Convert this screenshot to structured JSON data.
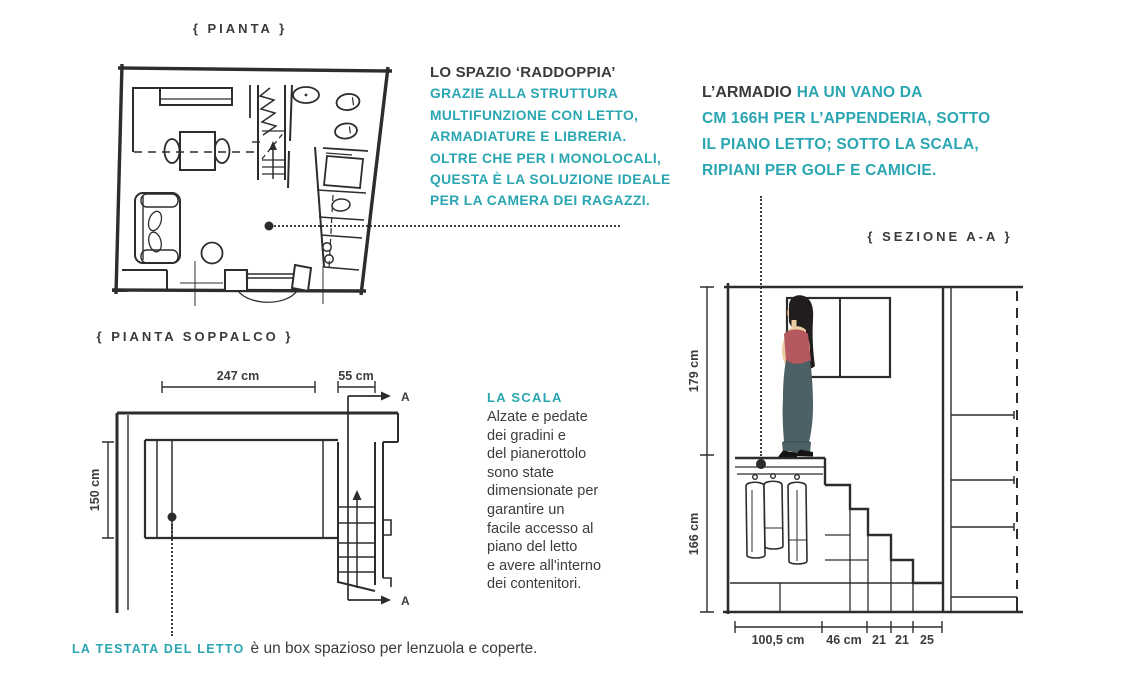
{
  "palette": {
    "teal": "#2aa6b2",
    "ink": "#3b3b3b",
    "drawing_line": "#2f2d2b",
    "figure_top": "#b4595f",
    "figure_pants": "#4c6065",
    "figure_hair": "#211d1d",
    "figure_skin": "#edcba4"
  },
  "titles": {
    "pianta": "{ PIANTA }",
    "soppalco": "{ PIANTA SOPPALCO }",
    "sezione": "{ SEZIONE A-A }"
  },
  "annotations": {
    "spazio": {
      "lead": "LO SPAZIO ‘RADDOPPIA’",
      "lines": [
        "GRAZIE ALLA STRUTTURA",
        "MULTIFUNZIONE CON LETTO,",
        "ARMADIATURE E LIBRERIA.",
        "OLTRE CHE PER I MONOLOCALI,",
        "QUESTA È LA SOLUZIONE IDEALE",
        "PER LA CAMERA DEI RAGAZZI."
      ]
    },
    "armadio": {
      "lead": "L’ARMADIO",
      "lead_rest": "HA UN VANO DA",
      "lines": [
        "CM 166H PER L’APPENDERIA, SOTTO",
        "IL PIANO LETTO; SOTTO LA SCALA,",
        "RIPIANI PER GOLF E CAMICIE."
      ]
    },
    "scala": {
      "label": "LA SCALA",
      "lines": [
        "Alzate e pedate",
        "dei gradini e",
        "del pianerottolo",
        "sono state",
        "dimensionate per",
        "garantire un",
        "facile accesso al",
        "piano del letto",
        "e avere all'interno",
        "dei contenitori."
      ]
    },
    "testata": {
      "label": "LA TESTATA DEL LETTO",
      "text": "è un box spazioso per lenzuola e coperte."
    }
  },
  "dimensions": {
    "soppalco": {
      "width": "247 cm",
      "stair": "55 cm",
      "depth": "150 cm",
      "marker": "A"
    },
    "section": {
      "upper": "179 cm",
      "lower": "166 cm",
      "floor": [
        "100,5 cm",
        "46 cm",
        "21",
        "21",
        "25"
      ]
    }
  }
}
